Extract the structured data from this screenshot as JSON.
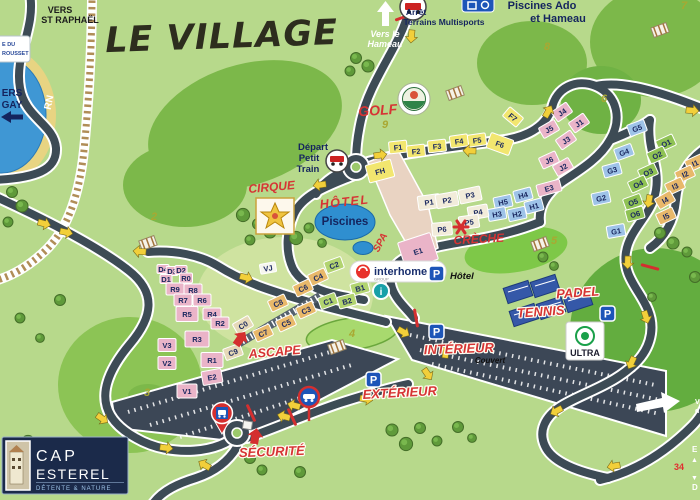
{
  "title": "LE VILLAGE",
  "colors": {
    "background": "#b7d98b",
    "road": "#3d4b55",
    "sea": "#3f97d4",
    "sand": "#e8d482",
    "red_label": "#d63434",
    "navy": "#14245e",
    "parking_blue": "#1d55b8",
    "pin_red": "#d42f2f",
    "building": {
      "y": "#f2e66f",
      "p": "#eab4c8",
      "b": "#9ec3e8",
      "g": "#8fc254",
      "o": "#e8b86a",
      "t": "#e6d9b8",
      "c": "#f2ecda",
      "l": "#b2d470",
      "w": "#f6f6ee"
    }
  },
  "signs": {
    "vers1": "VERS",
    "vers2": "ST RAPHAËL",
    "rousset1": "E DU",
    "rousset2": "ROUSSET",
    "agay1": "ERS",
    "agay2": "GAY",
    "rn": "RN",
    "hameau1": "Vers le",
    "hameau2": "Hameau",
    "arret1": "Arrêt",
    "arret2": "Terrains Multisports",
    "ado1": "Piscines Ado",
    "ado2": "et Hameau",
    "depart1": "Départ",
    "depart2": "Petit",
    "depart3": "Train",
    "golf": "GOLF",
    "cirque": "CIRQUE",
    "hotel": "HÔTEL",
    "spa": "SPA",
    "piscines": "Piscines",
    "creche": "CRÈCHE",
    "padel1": "PADEL",
    "padel2": "TENNIS",
    "ascape": "ASCAPE",
    "interieur": "INTÉRIEUR",
    "couvert": "Couvert",
    "exterieur": "EXTÉRIEUR",
    "securite": "SÉCURITÉ",
    "p": "P",
    "p_hotel": "Hôtel",
    "info": "i",
    "interhome": "interhome",
    "interhome_sub": "GROUP",
    "ultra": "ULTRA",
    "cap1": "CAP",
    "cap2": "ESTEREL",
    "cap_tagline": "DÉTENTE & NATURE",
    "edge_e": "E",
    "edge_up": "▲",
    "edge_num": "34",
    "edge_down": "▼",
    "edge_d": "D",
    "edge_v": "V",
    "edge_de": "d"
  },
  "golf_holes": [
    {
      "n": "2",
      "x": 154,
      "y": 220
    },
    {
      "n": "3",
      "x": 147,
      "y": 396
    },
    {
      "n": "4",
      "x": 352,
      "y": 337
    },
    {
      "n": "5",
      "x": 554,
      "y": 244
    },
    {
      "n": "6",
      "x": 604,
      "y": 102
    },
    {
      "n": "7",
      "x": 684,
      "y": 9
    },
    {
      "n": "8",
      "x": 547,
      "y": 50
    },
    {
      "n": "9",
      "x": 385,
      "y": 128
    }
  ],
  "buildings": [
    {
      "l": "F1",
      "x": 398,
      "y": 147,
      "c": "y",
      "r": -6
    },
    {
      "l": "F2",
      "x": 416,
      "y": 151,
      "c": "y",
      "r": -6
    },
    {
      "l": "F3",
      "x": 437,
      "y": 146,
      "c": "y",
      "r": -6
    },
    {
      "l": "F4",
      "x": 459,
      "y": 141,
      "c": "y",
      "r": -8
    },
    {
      "l": "F5",
      "x": 477,
      "y": 140,
      "c": "y",
      "r": -8
    },
    {
      "l": "F6",
      "x": 500,
      "y": 144,
      "c": "y",
      "r": 20,
      "w": 24,
      "h": 16
    },
    {
      "l": "F7",
      "x": 513,
      "y": 117,
      "c": "y",
      "r": 40
    },
    {
      "l": "FH",
      "x": 380,
      "y": 171,
      "c": "y",
      "r": -15,
      "w": 26,
      "h": 18
    },
    {
      "l": "J4",
      "x": 562,
      "y": 112,
      "c": "p",
      "r": -35
    },
    {
      "l": "J1",
      "x": 579,
      "y": 123,
      "c": "p",
      "r": -35
    },
    {
      "l": "J5",
      "x": 549,
      "y": 129,
      "c": "p",
      "r": -30
    },
    {
      "l": "J3",
      "x": 566,
      "y": 140,
      "c": "p",
      "r": -35
    },
    {
      "l": "J6",
      "x": 549,
      "y": 160,
      "c": "p",
      "r": -25
    },
    {
      "l": "J2",
      "x": 563,
      "y": 167,
      "c": "p",
      "r": -30
    },
    {
      "l": "E3",
      "x": 549,
      "y": 188,
      "c": "p",
      "r": -15,
      "w": 24
    },
    {
      "l": "E1",
      "x": 418,
      "y": 251,
      "c": "p",
      "r": -18,
      "w": 34,
      "h": 28
    },
    {
      "l": "E2",
      "x": 212,
      "y": 377,
      "c": "p",
      "r": -10,
      "w": 20,
      "h": 14
    },
    {
      "l": "H4",
      "x": 523,
      "y": 195,
      "c": "b",
      "r": -15
    },
    {
      "l": "H5",
      "x": 503,
      "y": 202,
      "c": "b",
      "r": -12
    },
    {
      "l": "H1",
      "x": 534,
      "y": 206,
      "c": "b",
      "r": -15
    },
    {
      "l": "H3",
      "x": 497,
      "y": 214,
      "c": "b",
      "r": -10
    },
    {
      "l": "H2",
      "x": 517,
      "y": 214,
      "c": "b",
      "r": -12
    },
    {
      "l": "G5",
      "x": 637,
      "y": 128,
      "c": "b",
      "r": -20
    },
    {
      "l": "G4",
      "x": 624,
      "y": 152,
      "c": "b",
      "r": -20
    },
    {
      "l": "G3",
      "x": 612,
      "y": 170,
      "c": "b",
      "r": -15
    },
    {
      "l": "G2",
      "x": 601,
      "y": 198,
      "c": "b",
      "r": -12
    },
    {
      "l": "G1",
      "x": 616,
      "y": 231,
      "c": "b",
      "r": -10
    },
    {
      "l": "O1",
      "x": 666,
      "y": 143,
      "c": "g",
      "r": -25
    },
    {
      "l": "O2",
      "x": 657,
      "y": 155,
      "c": "g",
      "r": -25
    },
    {
      "l": "O3",
      "x": 648,
      "y": 172,
      "c": "g",
      "r": -25
    },
    {
      "l": "O4",
      "x": 638,
      "y": 184,
      "c": "g",
      "r": -25
    },
    {
      "l": "O5",
      "x": 633,
      "y": 202,
      "c": "g",
      "r": -20
    },
    {
      "l": "O6",
      "x": 635,
      "y": 214,
      "c": "g",
      "r": -15
    },
    {
      "l": "I1",
      "x": 695,
      "y": 163,
      "c": "o",
      "r": -25
    },
    {
      "l": "I2",
      "x": 685,
      "y": 174,
      "c": "o",
      "r": -25
    },
    {
      "l": "I3",
      "x": 675,
      "y": 186,
      "c": "o",
      "r": -25
    },
    {
      "l": "I4",
      "x": 665,
      "y": 200,
      "c": "o",
      "r": -30
    },
    {
      "l": "I5",
      "x": 666,
      "y": 216,
      "c": "o",
      "r": -25
    },
    {
      "l": "P1",
      "x": 429,
      "y": 202,
      "c": "c",
      "r": -8,
      "w": 22,
      "h": 14
    },
    {
      "l": "P2",
      "x": 447,
      "y": 200,
      "c": "c",
      "r": -10,
      "w": 22,
      "h": 14
    },
    {
      "l": "P3",
      "x": 470,
      "y": 195,
      "c": "c",
      "r": -12,
      "w": 22,
      "h": 14
    },
    {
      "l": "P4",
      "x": 478,
      "y": 212,
      "c": "c",
      "r": -10,
      "w": 20,
      "h": 13
    },
    {
      "l": "P5",
      "x": 469,
      "y": 222,
      "c": "c",
      "r": -8,
      "w": 20,
      "h": 13
    },
    {
      "l": "P6",
      "x": 442,
      "y": 229,
      "c": "c",
      "r": -5,
      "w": 20,
      "h": 13
    },
    {
      "l": "D4",
      "x": 163,
      "y": 269,
      "c": "p",
      "w": 12,
      "h": 9
    },
    {
      "l": "D3",
      "x": 172,
      "y": 271,
      "c": "p",
      "w": 12,
      "h": 9
    },
    {
      "l": "D2",
      "x": 181,
      "y": 270,
      "c": "p",
      "w": 12,
      "h": 9
    },
    {
      "l": "D1",
      "x": 166,
      "y": 279,
      "c": "p",
      "w": 12,
      "h": 9
    },
    {
      "l": "R0",
      "x": 186,
      "y": 278,
      "c": "p",
      "w": 13,
      "h": 10
    },
    {
      "l": "R9",
      "x": 175,
      "y": 289,
      "c": "p"
    },
    {
      "l": "R8",
      "x": 193,
      "y": 290,
      "c": "p"
    },
    {
      "l": "R7",
      "x": 183,
      "y": 300,
      "c": "p"
    },
    {
      "l": "R6",
      "x": 202,
      "y": 300,
      "c": "p"
    },
    {
      "l": "R5",
      "x": 187,
      "y": 314,
      "c": "p",
      "w": 22,
      "h": 15
    },
    {
      "l": "R4",
      "x": 212,
      "y": 314,
      "c": "p"
    },
    {
      "l": "R2",
      "x": 220,
      "y": 323,
      "c": "p"
    },
    {
      "l": "R3",
      "x": 197,
      "y": 339,
      "c": "p",
      "w": 24,
      "h": 16
    },
    {
      "l": "R1",
      "x": 212,
      "y": 360,
      "c": "p",
      "w": 22,
      "h": 15
    },
    {
      "l": "V3",
      "x": 167,
      "y": 345,
      "c": "p",
      "w": 18,
      "h": 13
    },
    {
      "l": "V2",
      "x": 167,
      "y": 363,
      "c": "p",
      "w": 18,
      "h": 13
    },
    {
      "l": "V1",
      "x": 187,
      "y": 391,
      "c": "p",
      "w": 20,
      "h": 14
    },
    {
      "l": "C2",
      "x": 334,
      "y": 265,
      "c": "l",
      "r": -20
    },
    {
      "l": "C4",
      "x": 318,
      "y": 277,
      "c": "o",
      "r": -25
    },
    {
      "l": "C6",
      "x": 303,
      "y": 288,
      "c": "o",
      "r": -25
    },
    {
      "l": "C8",
      "x": 278,
      "y": 303,
      "c": "o",
      "r": -25
    },
    {
      "l": "C1",
      "x": 328,
      "y": 301,
      "c": "l",
      "r": -20
    },
    {
      "l": "C3",
      "x": 306,
      "y": 310,
      "c": "o",
      "r": -25
    },
    {
      "l": "C5",
      "x": 286,
      "y": 323,
      "c": "o",
      "r": -25
    },
    {
      "l": "C7",
      "x": 263,
      "y": 333,
      "c": "o",
      "r": -25
    },
    {
      "l": "C0",
      "x": 243,
      "y": 325,
      "c": "t",
      "r": -30
    },
    {
      "l": "C9",
      "x": 233,
      "y": 352,
      "c": "t",
      "r": -20
    },
    {
      "l": "B1",
      "x": 360,
      "y": 288,
      "c": "l",
      "r": -15
    },
    {
      "l": "B2",
      "x": 347,
      "y": 301,
      "c": "l",
      "r": -15
    },
    {
      "l": "VJ",
      "x": 268,
      "y": 268,
      "c": "w",
      "r": -10,
      "w": 16,
      "h": 10
    }
  ]
}
